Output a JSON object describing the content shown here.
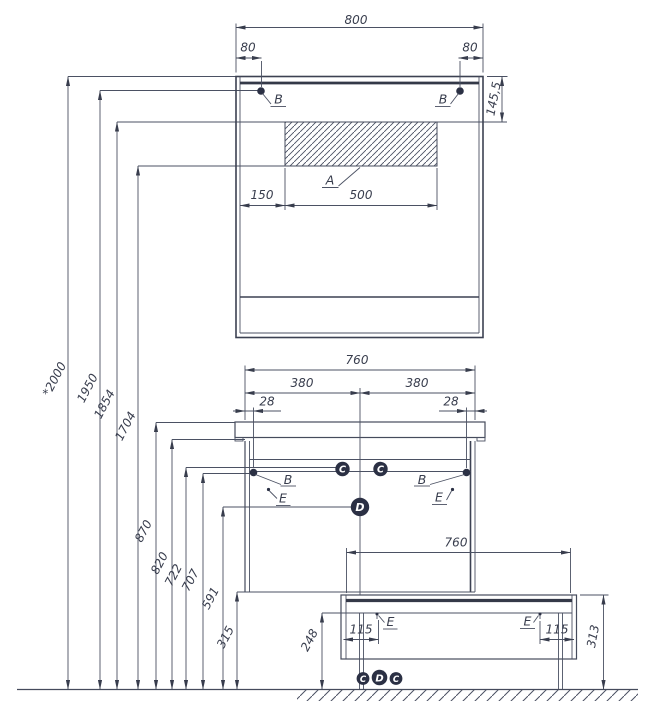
{
  "colors": {
    "line": "#4b5163",
    "text": "#383d4d",
    "marker_fill": "#2b3044",
    "background": "#ffffff"
  },
  "mirror_cabinet": {
    "dim_width": "800",
    "dim_mount_offset_left": "80",
    "dim_mount_offset_right": "80",
    "dim_mount_height": "145,5",
    "dim_zone_offset": "150",
    "dim_zone_width": "500",
    "label_zone": "A",
    "label_mount_left": "B",
    "label_mount_right": "B"
  },
  "vanity": {
    "dim_width": "760",
    "dim_half_left": "380",
    "dim_half_right": "380",
    "dim_mount_inset_left": "28",
    "dim_mount_inset_right": "28",
    "label_mount_left": "B",
    "label_mount_right": "B",
    "label_c_left": "C",
    "label_c_right": "C",
    "label_d": "D",
    "label_e_left": "E",
    "label_e_right": "E"
  },
  "base_unit": {
    "dim_width": "760",
    "dim_height": "313",
    "dim_foot_inset_left": "115",
    "dim_foot_inset_right": "115",
    "label_e_left": "E",
    "label_e_right": "E",
    "label_c_left": "C",
    "label_d": "D",
    "label_c_right": "C"
  },
  "height_dims": [
    "*2000",
    "1950",
    "1854",
    "1704",
    "870",
    "820",
    "722",
    "707",
    "591",
    "315",
    "248"
  ]
}
